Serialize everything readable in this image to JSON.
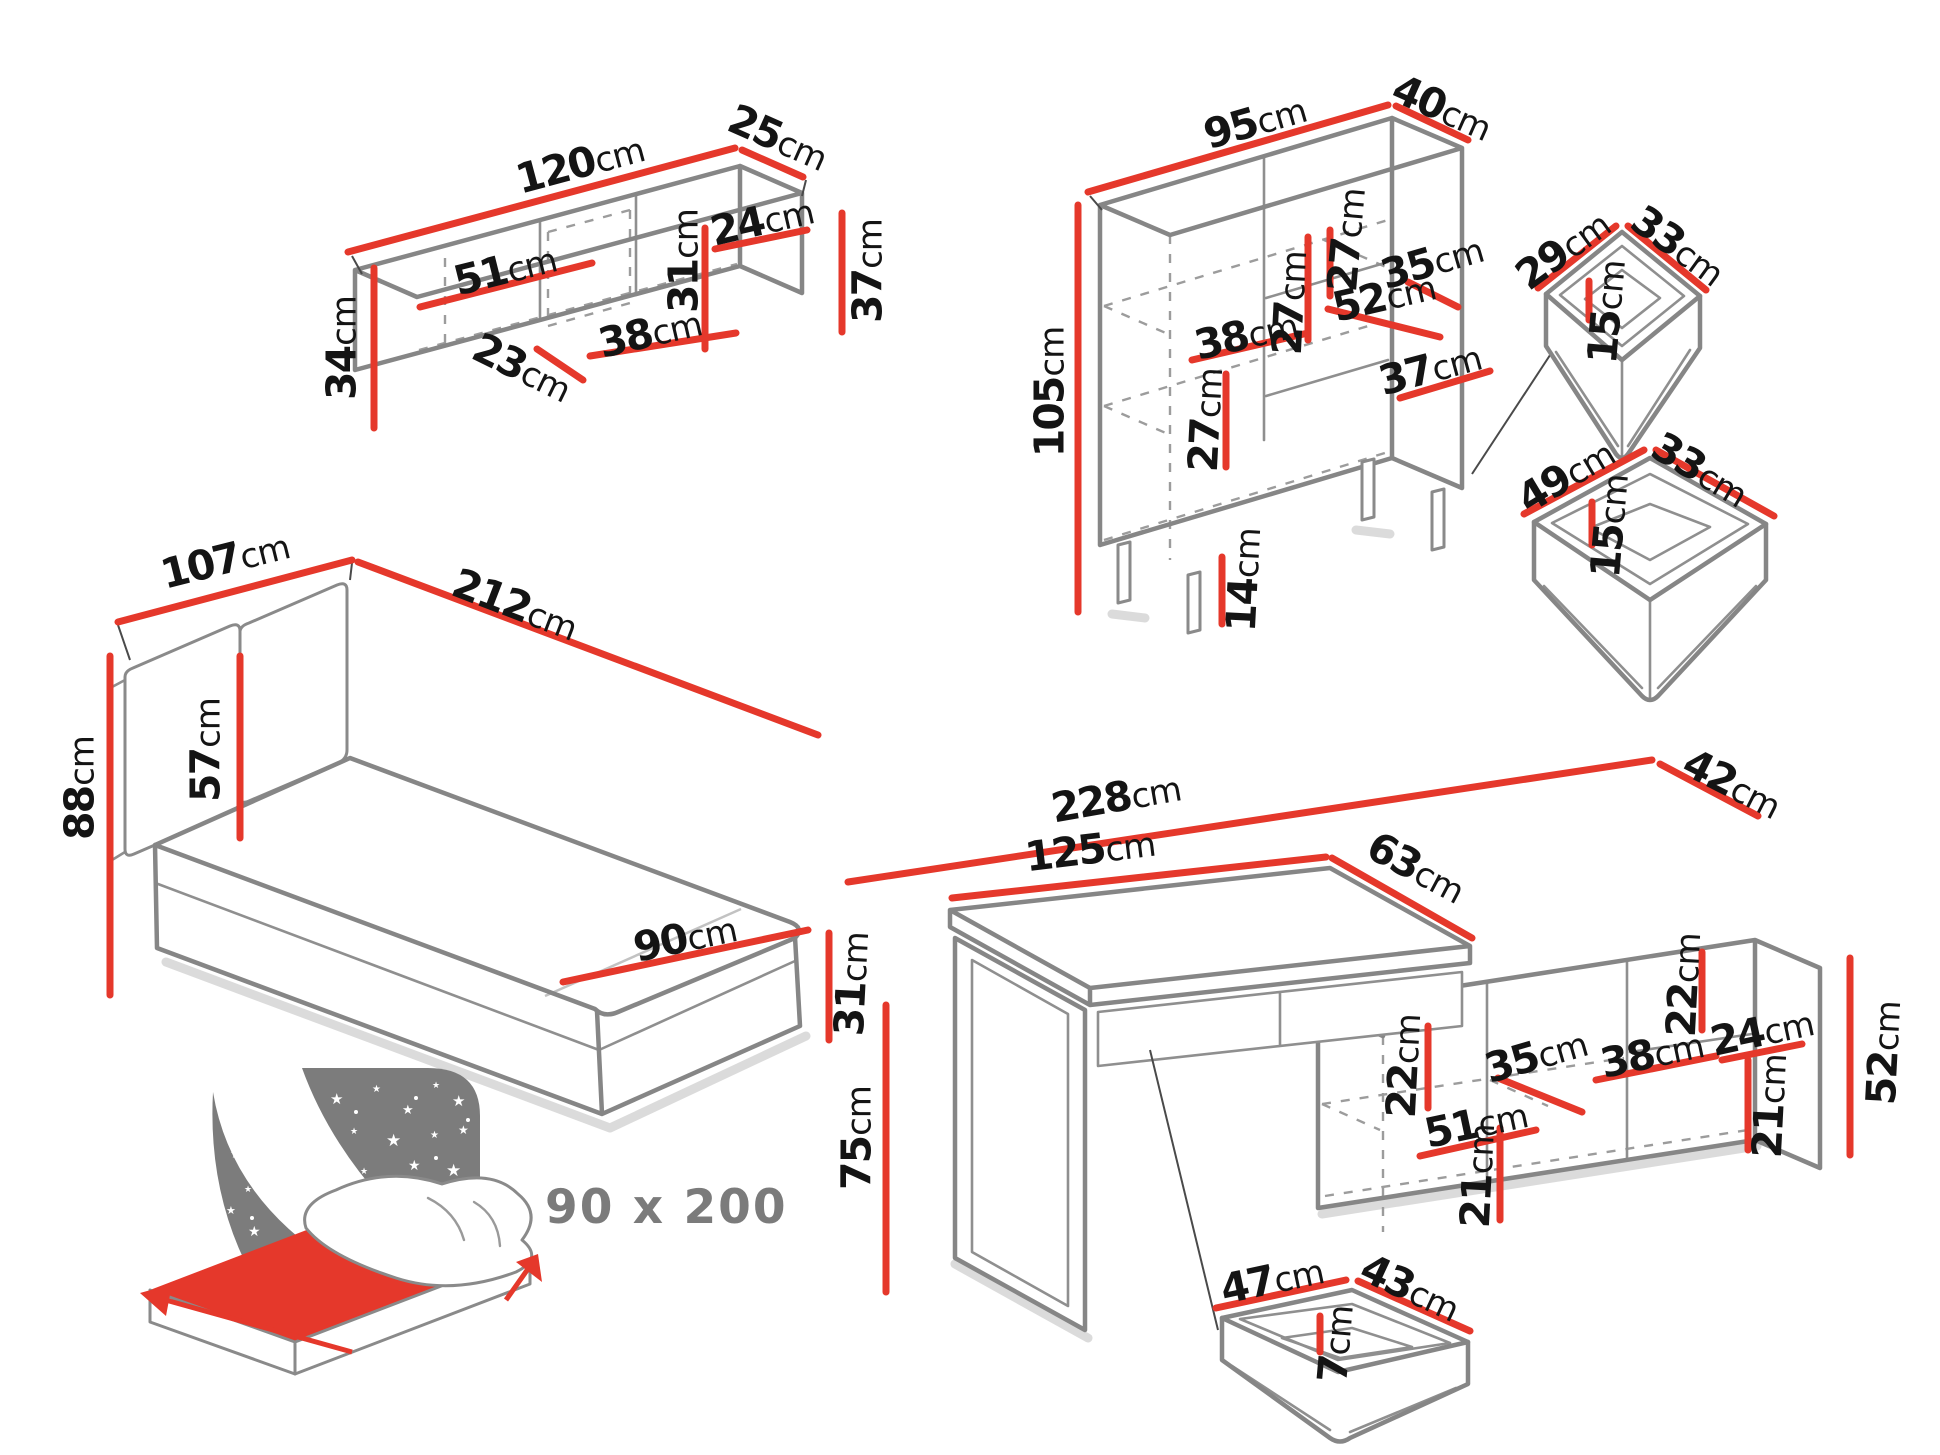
{
  "unit": "cm",
  "caption": "90 x 200",
  "colors": {
    "red": "#e5382b",
    "outline": "#868686",
    "icon_gray": "#7c7c7c",
    "text": "#141414",
    "caption_gray": "#7b7b7b"
  },
  "wall_shelf": {
    "width": "120",
    "depth": "25",
    "height": "34",
    "left_compartment_width": "51",
    "door_width": "23",
    "middle_compartment_width": "38",
    "inner_height": "31",
    "right_compartment_width": "24",
    "side_height": "37"
  },
  "bookcase": {
    "width": "95",
    "depth": "40",
    "height": "105",
    "upper_gap_a": "27",
    "upper_gap_b": "27",
    "right_shelf_width": "35",
    "left_shelf_width": "52",
    "middle_width": "38",
    "lower_gap": "27",
    "lower_shelf_width": "37",
    "leg_height": "14"
  },
  "small_drawer": {
    "depth": "29",
    "width": "33",
    "height": "15"
  },
  "large_drawer": {
    "depth": "49",
    "width": "33",
    "height": "15"
  },
  "bed": {
    "headboard_width": "107",
    "length": "212",
    "headboard_height": "88",
    "headboard_panel_height": "57",
    "foot_width": "90",
    "frame_height": "31"
  },
  "desk": {
    "total_width": "228",
    "desktop_width": "125",
    "desktop_depth": "63",
    "cabinet_depth": "42",
    "height": "75",
    "cabinet_height": "52",
    "cabinet_top_gap": "22",
    "right_compartment_width": "24",
    "right_inner_height": "21",
    "middle_shelf_width": "35",
    "middle_compartment_width": "38",
    "left_compartment_width": "51",
    "left_gap": "22",
    "left_inner_height": "21"
  },
  "desk_drawer": {
    "width": "47",
    "depth": "43",
    "height": "7"
  }
}
